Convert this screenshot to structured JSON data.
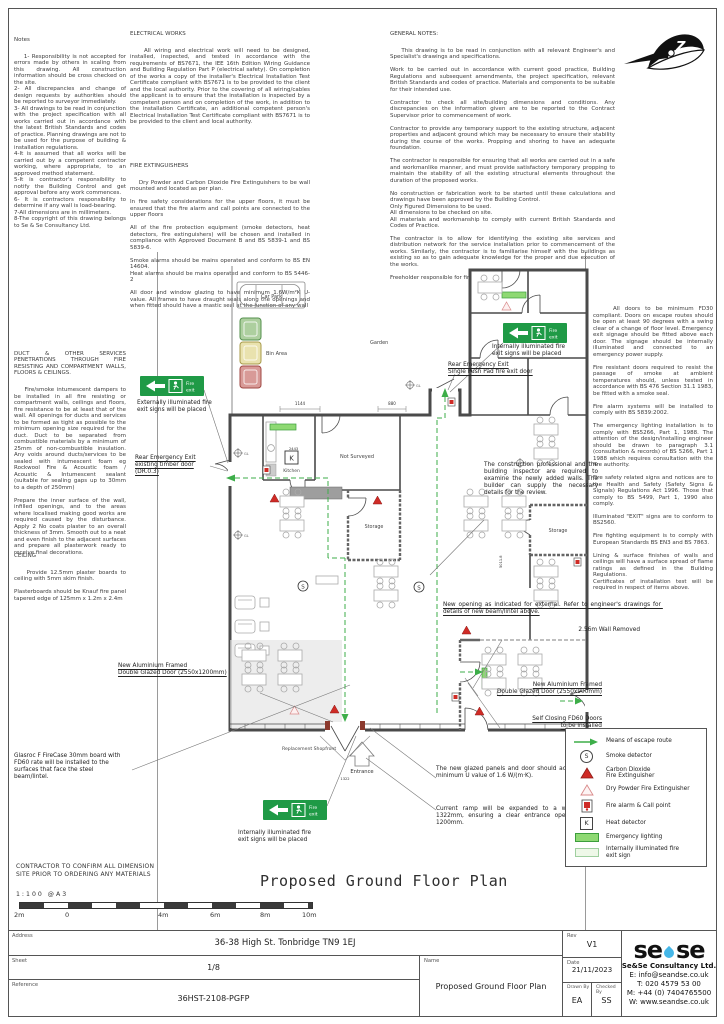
{
  "notes_left": {
    "title": "Notes",
    "body": "1- Responsibility is not accepted for errors made by others in scaling from this drawing. All construction information should be cross checked on the site.\n2- All discrepancies and change of design requests by authorities should be reported to surveyor immediately.\n3- All drawings to be read in conjunction with the project specification with all works carried out in accordance with the latest British Standards and codes of practice. Planning drawings are not to be used for the purpose of building & installation regulations.\n4-It is assumed that all works will be carried out by a competent contractor working, where appropriate, to an approved method statement.\n5-It is contractor's responsibility to notify the Building Control and get approval before any work commences.\n6- It is contractors responsibility to determine if any wall is load-bearing.\n7-All dimensions are in millimeters.\n8-The copyright of this drawing belongs to Se & Se Consultancy Ltd."
  },
  "electrical": {
    "title": "ELECTRICAL WORKS",
    "body": "All wiring and electrical work will need to be designed, installed, inspected, and tested in accordance with the requirements of BS7671, the IEE 16th Edition Wiring Guidance and Building Regulation Part P (electrical safety). On completion of the works a copy of the installer's Electrical Installation Test Certificate compliant with BS7671 is to be provided to the client and the local authority. Prior to the covering of all wiring/cables the applicant is to ensure that the installation is inspected by a competent person and on completion of the work, in addition to the installation Certificate, an additional competent person's Electrical Installation Test Certificate compliant with BS7671 is to be provided to the client and local authority."
  },
  "fire_ext": {
    "title": "FIRE EXTINGUISHERS",
    "body": "Dry Powder and Carbon Dioxide Fire Extinguishers to be wall mounted and located as per plan.\n\nIn fire safety considerations for the upper floors, it must be ensured that the fire alarm and call points are connected to the upper floors\n\nAll of the fire protection equipment (smoke detectors, heat detectors, fire extinguishers) will be chosen and installed in compliance with Approved Document B and BS 5839-1 and BS 5839-6.\n\nSmoke alarms should be mains operated and conform to BS EN 14604.\nHeat alarms should be mains operated and conform to BS 5446-2\n\nAll door and window glazing to have minimum 1.6W/m²K U-value. All frames to have draught seals along the openings and when fitted should have a mastic seal at the junction of any wall"
  },
  "general": {
    "title": "GENERAL NOTES:",
    "body": "This drawing is to be read in conjunction with all relevant Engineer's and Specialist's drawings and specifications.\n\nWork to be carried out in accordance with current good practice, Building Regulations and subsequent amendments, the project specification, relevant British Standards and codes of practice. Materials and components to be suitable for their intended use.\n\nContractor to check all site/building dimensions and conditions. Any discrepancies on the information given are to be reported to the Contract Supervisor prior to commencement of work.\n\nContractor to provide any temporary support to the existing structure, adjacent properties and adjacent ground which may be necessary to ensure their stability during the course of the works. Propping and shoring to have an adequate foundation.\n\nThe contractor is responsible for ensuring that all works are carried out in a safe and workmanlike manner, and must provide satisfactory temporary propping to maintain the stability of all the existing structural elements throughout the duration of the proposed works.\n\nNo construction or fabrication work to be started until these calculations and drawings have been approved by the Building Control.\nOnly Figured Dimensions to be used.\nAll dimensions to be checked on site.\nAll materials and workmanship to comply with current British Standards and Codes of Practice.\n\nThe contractor is to allow for identifying the existing site services and distribution network for the service installation prior to commencement of the works. Similarly, the contractor is to familiarise himself with the buildings as existing so as to gain adequate knowledge for the proper and due execution of the works.\n\nFreeholder responsible for fire safety on upper floors"
  },
  "duct": {
    "title": "DUCT & OTHER SERVICES PENETRATIONS THROUGH FIRE RESISTING AND COMPARTMENT WALLS, FLOORS & CEILINGS.",
    "body": "Fire/smoke intumescent dampers to be installed in all fire resisting or compartment walls, ceilings and floors, fire resistance to be at least that of the wall. All openings for ducts and services to be formed as tight as possible to the minimum opening size required for the duct. Duct to be separated from combustible materials by a minimum of 25mm of non-combustible insulation. Any voids around ducts/services to be sealed with intumescent foam eg Rockwool Fire & Acoustic foam / Acoustic & Intumescent sealant (suitable for sealing gaps up to 30mm to a depth of 250mm)\n\nPrepare the inner surface of the wall, infilled openings, and to the areas where localised making good works are required caused by the disturbance. Apply 2 No coats plaster to an overall thickness of 3mm. Smooth out to a neat and even finish to the adjacent surfaces and prepare all plasterwork ready to receive final decorations."
  },
  "ceiling": {
    "title": "CEILING",
    "body": "Provide 12.5mm plaster boards to ceiling with 5mm skim finish.\n\nPlasterboards should be Knauf fire panel tapered edge of 125mm x 1.2m x 2.4m"
  },
  "right_notes": {
    "body": "All doors to be minimum FD30 compliant. Doors on escape routes should be open at least 90 degrees with a swing clear of a change of floor level. Emergency exit signage should be fitted above each door. The signage should be internally illuminated and connected to an emergency power supply.\n\nFire resistant doors required to resist the passage of smoke at ambient temperatures should, unless tested in accordance with BS 476 Section 31.1 1983, be fitted with a smoke seal.\n\nFire alarm systems will be installed to comply with BS 5839:2002.\n\nThe emergency lighting installation is to comply with BS5266, Part 1, 1988. The attention of the design/installing engineer should be drawn to paragraph 3.1 (consultation & records) of BS 5266, Part 1 1988 which requires consultation with the fire authority.\n\nFire safety related signs and notices are to the Health and Safety (Safety Signs & Signals) Regulations Act 1996. Those that comply to BS 5499, Part 1, 1990 also comply.\n\nIlluminated \"EXIT\" signs are to conform to BS2560.\n\nFire fighting equipment is to comply with European Standards BS EN3 and BS 7863.\n\nLining & surface finishes of walls and ceilings will have a surface spread of flame ratings as defined in the Building Regulations.\nCertificates of installation test will be required in respect of items above."
  },
  "plan": {
    "title": "Proposed Ground Floor Plan",
    "labels": {
      "car_park": "Car Park",
      "bin_area": "Bin Area",
      "garden": "Garden",
      "not_surveyed": "Not Surveyed",
      "kitchen": "Kitchen",
      "k": "K",
      "s": "S",
      "storage1": "Storage",
      "storage2": "Storage",
      "entrance": "Entrance",
      "shopfront": "Replacement Shopfront",
      "gl": "GL"
    },
    "sign": {
      "line1": "Fire",
      "line2": "exit"
    },
    "dims": {
      "d1": "1144",
      "d2": "880",
      "d3": "2443",
      "d4": "5011.8",
      "d5": "1322"
    },
    "annotations": {
      "ext_sign": "Externally illuminated fire\nexit signs will be placed",
      "rear_timber": "Rear Emergency Exit\nexisting timber door\n(DR.0.3)",
      "int_sign_top": "Internally illuminated fire\nexit signs will be placed",
      "rear_push": "Rear Emergency Exit\nSingle Push Pad fire exit door",
      "construction": "The construction professional and the building inspector are required to examine the newly added walls. The builder can supply the necessary details for the review.",
      "new_opening": "New opening as indicated for external. Refer to engineer's drawings for details of new beam/lintel above.",
      "wall_removed": "2.56m Wall Removed",
      "door_left": "New Aluminium Framed\nDouble Glazed Door (2550x1200mm)",
      "door_right": "New Aluminium Framed\nDouble Glazed Door (2550x900mm)",
      "self_closing": "Self Closing FD60 Doors\nto be installed",
      "glasroc": "Glasroc F FireCase 30mm board with FD60 rate will be installed to the surfaces that face the steel beam/lintel.",
      "int_sign_bottom": "Internally illuminated fire\nexit signs will be placed",
      "glazed_panels": "The new glazed panels and door should achieve a minimum U value of 1.6 W/(m·K).",
      "ramp": "Current ramp will be expanded to a width of 1322mm, ensuring a clear entrance opening of 1200mm."
    },
    "legend": {
      "items": [
        "Means of escape route",
        "Smoke detector",
        "Carbon Dioxide\nFire Extinguisher",
        "Dry Powder Fire Extinguisher",
        "Fire alarm & Call point",
        "Heat detector",
        "Emergency lighting",
        "Internally illuminated fire\nexit sign"
      ]
    },
    "scale": {
      "confirm": "CONTRACTOR TO CONFIRM ALL DIMENSION\nSITE PRIOR TO ORDERING ANY MATERIALS",
      "ratio": "1:100  @A3",
      "ticks": [
        "2m",
        "0",
        "4m",
        "6m",
        "8m",
        "10m"
      ]
    },
    "compass_letter": "Z"
  },
  "colors": {
    "escape_green": "#3dae49",
    "sign_green": "#1f9a46",
    "extinguisher_red": "#cf2b26",
    "emergency_light": "#8ed973",
    "logo_blue": "#45b7e8"
  },
  "titleblock": {
    "address_label": "Address",
    "address": "36-38 High St. Tonbridge TN9 1EJ",
    "sheet_label": "Sheet",
    "sheet": "1/8",
    "reference_label": "Reference",
    "reference": "36HST-2108-PGFP",
    "name_label": "Name",
    "name": "Proposed Ground Floor Plan",
    "rev_label": "Rev",
    "rev": "V1",
    "date_label": "Date",
    "date": "21/11/2023",
    "drawn_label": "Drawn By",
    "drawn": "EA",
    "checked_label": "Checked By",
    "checked": "SS",
    "company": "Se&Se Consultancy Ltd.",
    "email": "E: info@seandse.co.uk",
    "tel": "T: 020 4579 53 00",
    "mobile": "M: +44 (0) 7404765500",
    "web": "W: www.seandse.co.uk",
    "logo_se1": "se",
    "logo_se2": "se"
  }
}
